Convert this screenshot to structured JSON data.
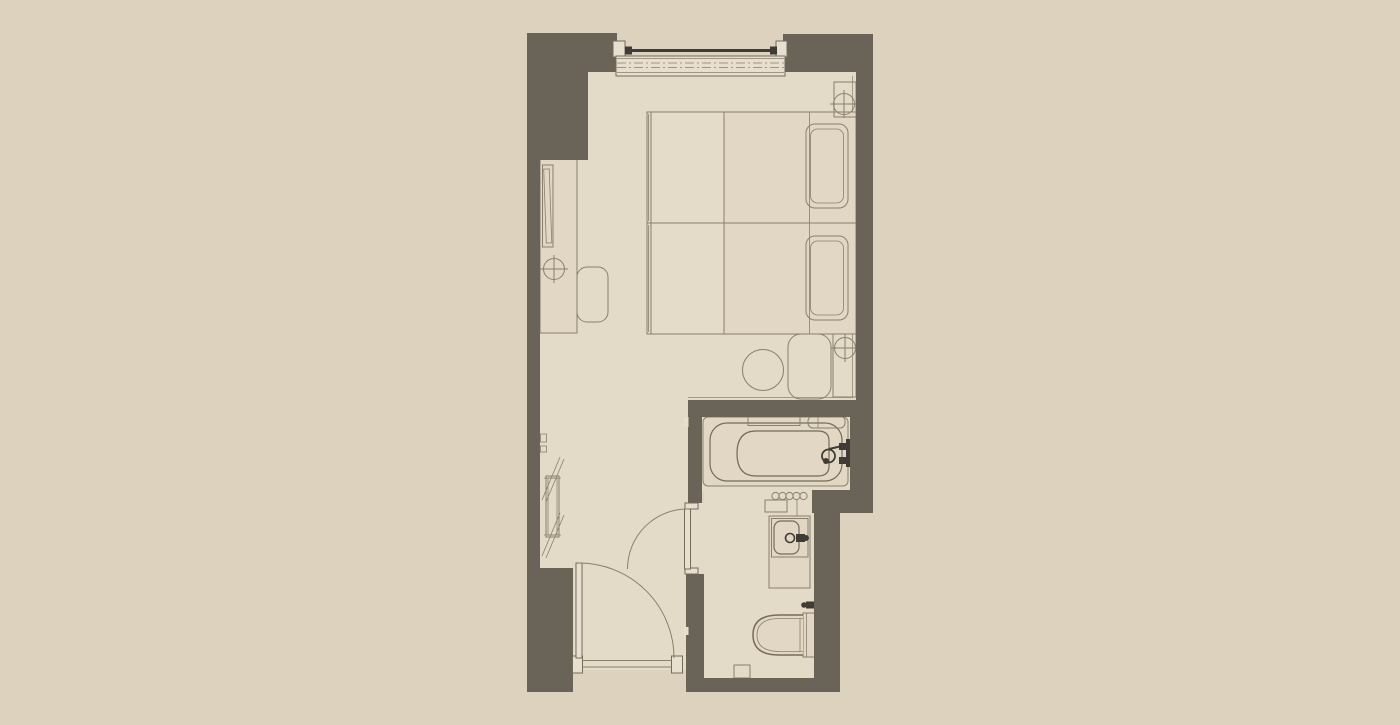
{
  "diagram": {
    "type": "architectural-floor-plan",
    "subject": "hotel-guestroom-unit",
    "rooms": [
      "bedroom",
      "entry-hall",
      "bathroom"
    ],
    "fixtures": [
      "window",
      "curtain-rod",
      "twin-bed-1",
      "twin-bed-2",
      "duvet-1",
      "duvet-2",
      "pillow-1",
      "pillow-2",
      "nightstand-top",
      "nightstand-bottom",
      "outlet-symbol-1",
      "outlet-symbol-2",
      "outlet-symbol-3",
      "desk",
      "tv",
      "desk-chair",
      "wardrobe",
      "round-stool",
      "ottoman",
      "bathtub",
      "tub-faucet",
      "tub-shelf",
      "soap-shelf",
      "towel-hooks",
      "vanity-counter",
      "sink",
      "sink-faucet",
      "toilet",
      "toilet-valve",
      "floor-drain-box",
      "entry-door",
      "entry-threshold",
      "bathroom-door"
    ]
  },
  "colors": {
    "bg": "#ddd2be",
    "floor": "#e3dac8",
    "wall": "#6a6357",
    "line": "#8a7f6d",
    "line2": "#746b5c",
    "furn": "#e1d7c4",
    "duvet": "#e4dbc9",
    "panel": "#e8e0cf",
    "glass": "#e7decd",
    "dark": "#3f3c35"
  }
}
